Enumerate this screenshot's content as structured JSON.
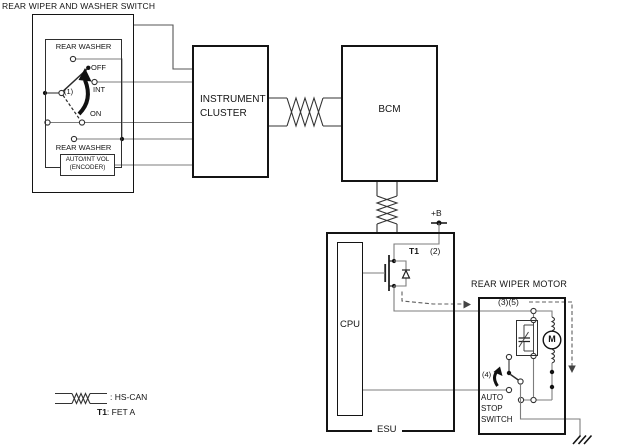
{
  "title": "REAR WIPER AND WASHER SWITCH",
  "switch_panel": {
    "rear_washer_top": "REAR WASHER",
    "pos_off": "OFF",
    "pos_int": "INT",
    "pos_on": "ON",
    "rotary_ref": "(1)",
    "rear_washer_bottom": "REAR WASHER",
    "encoder_line1": "AUTO/INT VOL",
    "encoder_line2": "(ENCODER)"
  },
  "instrument_cluster": {
    "line1": "INSTRUMENT",
    "line2": "CLUSTER"
  },
  "bcm": {
    "label": "BCM"
  },
  "esu": {
    "label": "ESU",
    "cpu": "CPU",
    "power": "+B",
    "fet_ref": "T1",
    "pin_2": "(2)"
  },
  "rear_wiper_motor": {
    "title": "REAR WIPER MOTOR",
    "pin_3_5": "(3)(5)",
    "pin_4": "(4)",
    "motor_m": "M",
    "auto_stop_line1": "AUTO",
    "auto_stop_line2": "STOP",
    "auto_stop_line3": "SWITCH"
  },
  "legend": {
    "hs_can": ": HS-CAN",
    "fet_ref": "T1",
    "fet_desc": ": FET A"
  },
  "colors": {
    "box": "#141414",
    "wire": "#7d7d7d",
    "dash": "#5f5f5f",
    "dot": "#111111"
  }
}
